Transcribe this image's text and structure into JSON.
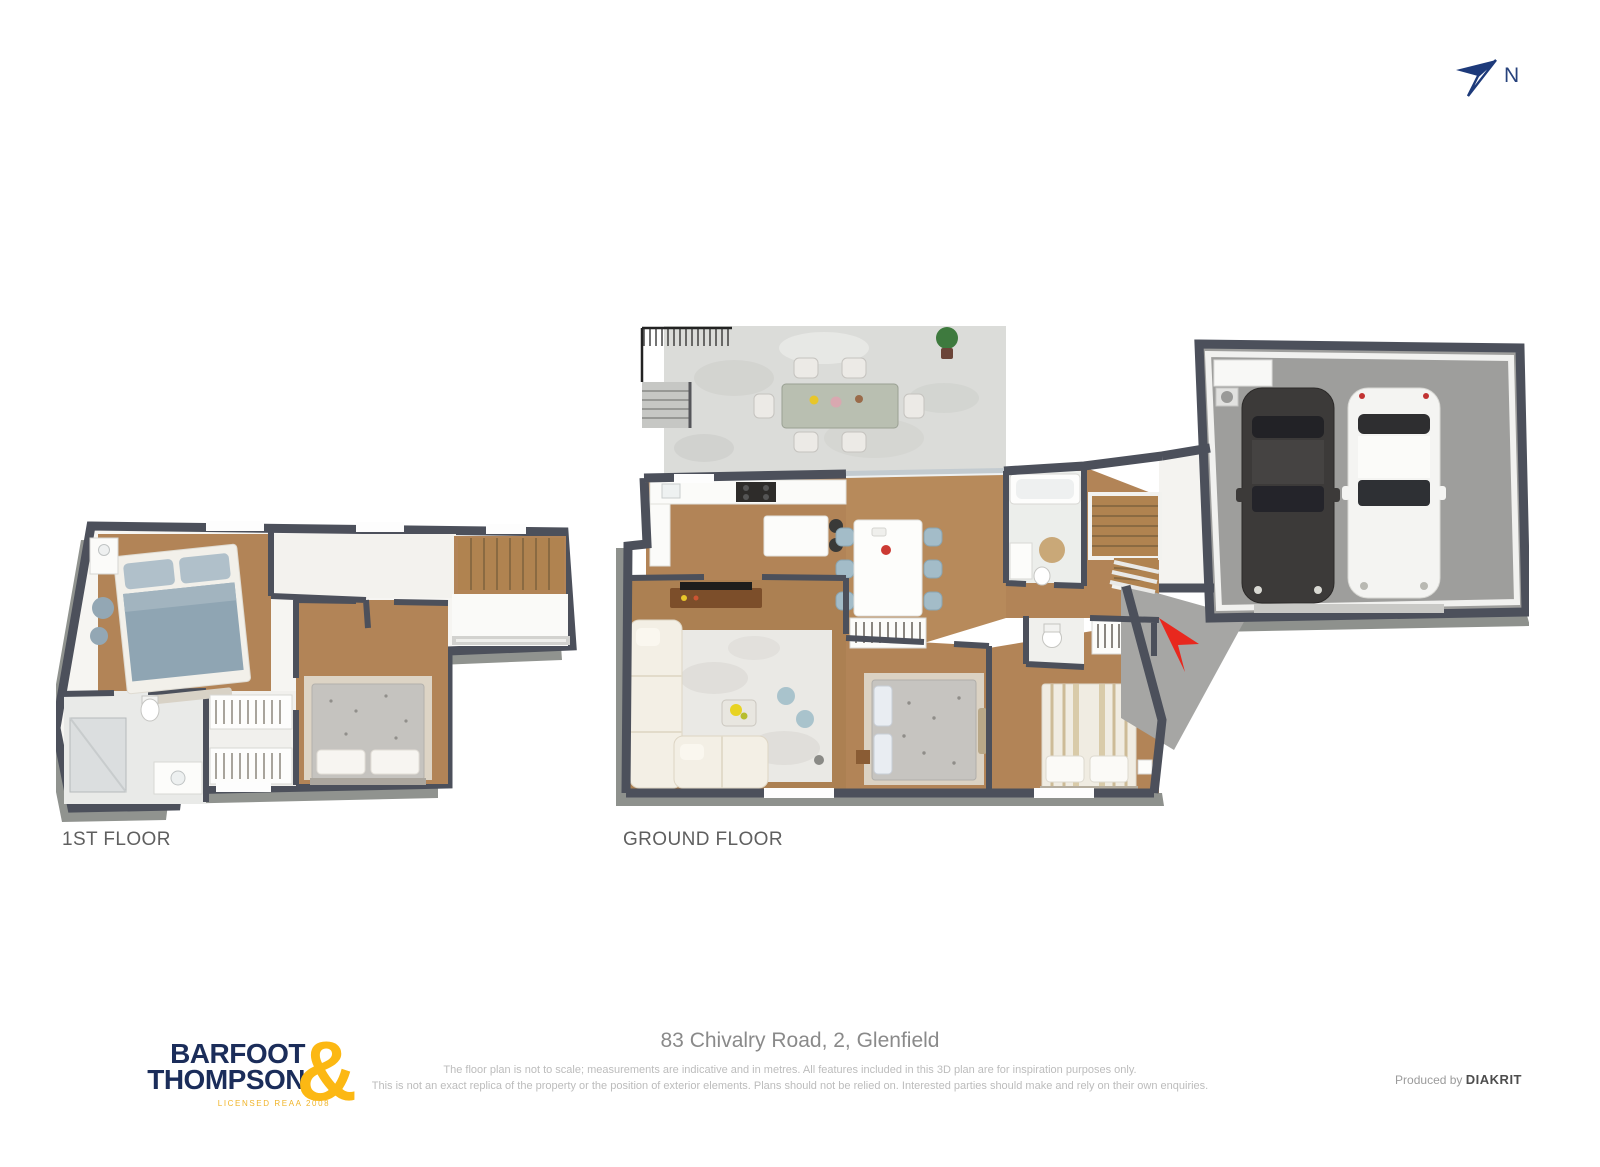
{
  "compass": {
    "label": "N"
  },
  "plans": {
    "first": {
      "label": "1ST FLOOR"
    },
    "ground": {
      "label": "GROUND FLOOR"
    }
  },
  "footer": {
    "logo": {
      "line1": "BARFOOT",
      "line2": "THOMPSON",
      "ampersand": "&",
      "license": "LICENSED REAA 2008"
    },
    "address": "83 Chivalry Road, 2, Glenfield",
    "disclaimer_line1": "The floor plan is not to scale; measurements are indicative and in metres. All features included in this 3D plan are for inspiration purposes only.",
    "disclaimer_line2": "This is not an exact replica of the property or the position of exterior elements. Plans should not be relied on. Interested parties should make and rely on their own enquiries.",
    "produced_by": "Produced by",
    "producer": "DIAKRIT"
  },
  "colors": {
    "wall": "#4c505b",
    "wood_floor": "#b28457",
    "deck_concrete": "#dbdcd9",
    "garage_floor": "#9e9e9c",
    "entrance_arrow_red": "#e8281e",
    "logo_navy": "#1b2d5a",
    "logo_yellow": "#fcb813",
    "compass_navy": "#27427c",
    "label_gray": "#5f5f5f",
    "disclaimer_gray": "#bcbcbc"
  }
}
